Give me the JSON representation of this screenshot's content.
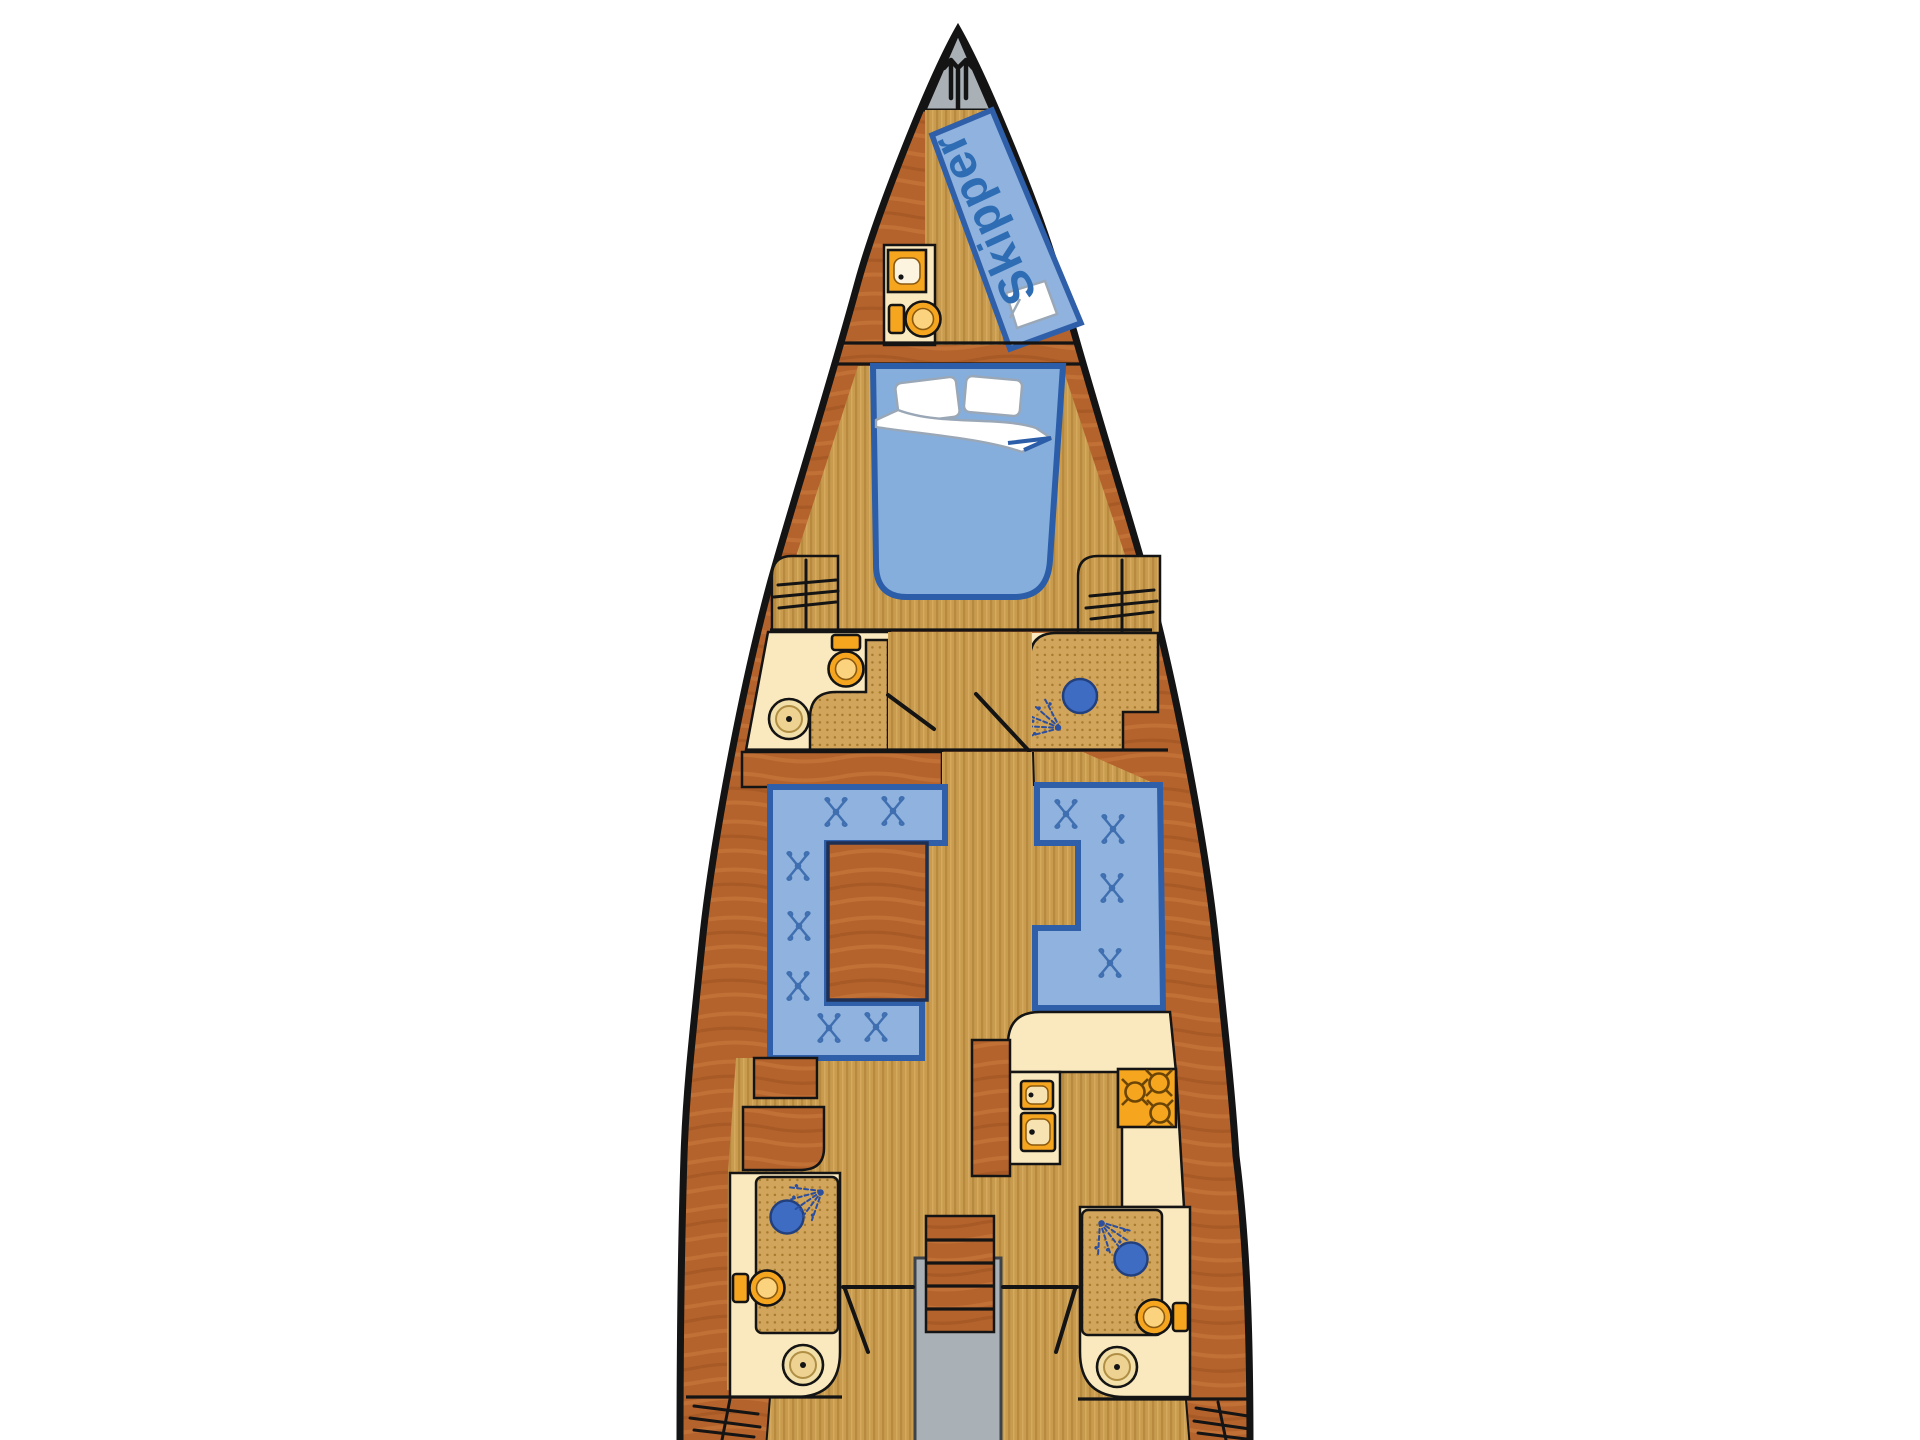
{
  "labels": {
    "skipper_berth": "Skipper"
  },
  "icons": {
    "bow": "anchor-icon",
    "wardrobe": "hanger-icon",
    "shower": "shower-spray-icon",
    "shower_head": "shower-drain-icon",
    "toilet": "toilet-icon",
    "washbasin": "washbasin-icon",
    "galley_sink": "sink-icon",
    "stove": "stove-burner-icon",
    "cushion": "cushion-stitch-icon"
  },
  "palette": {
    "hull_outline": "#141414",
    "wood_dark": "#B5632C",
    "wood_hi": "#C97A3E",
    "wood_lo": "#9C5120",
    "floor_base": "#C89B4F",
    "floor_stripe": "#B4873C",
    "floor_stripe2": "#D8AC60",
    "cream": "#FAE9BE",
    "mat_base": "#D2A55C",
    "mat_dot": "#A87C2E",
    "upholstery": "#8FB2DE",
    "upholstery_edge": "#2F5FA8",
    "stitch": "#3F6FB0",
    "bed_blue": "#85AEDC",
    "bed_edge": "#2B5DA8",
    "fixture": "#F6A51F",
    "fixture_hi": "#FBD27E",
    "deck_gray": "#A9B0B6",
    "drain": "#3D6CC2",
    "spray": "#2B4F9E",
    "label_blue": "#2E6DB4"
  }
}
